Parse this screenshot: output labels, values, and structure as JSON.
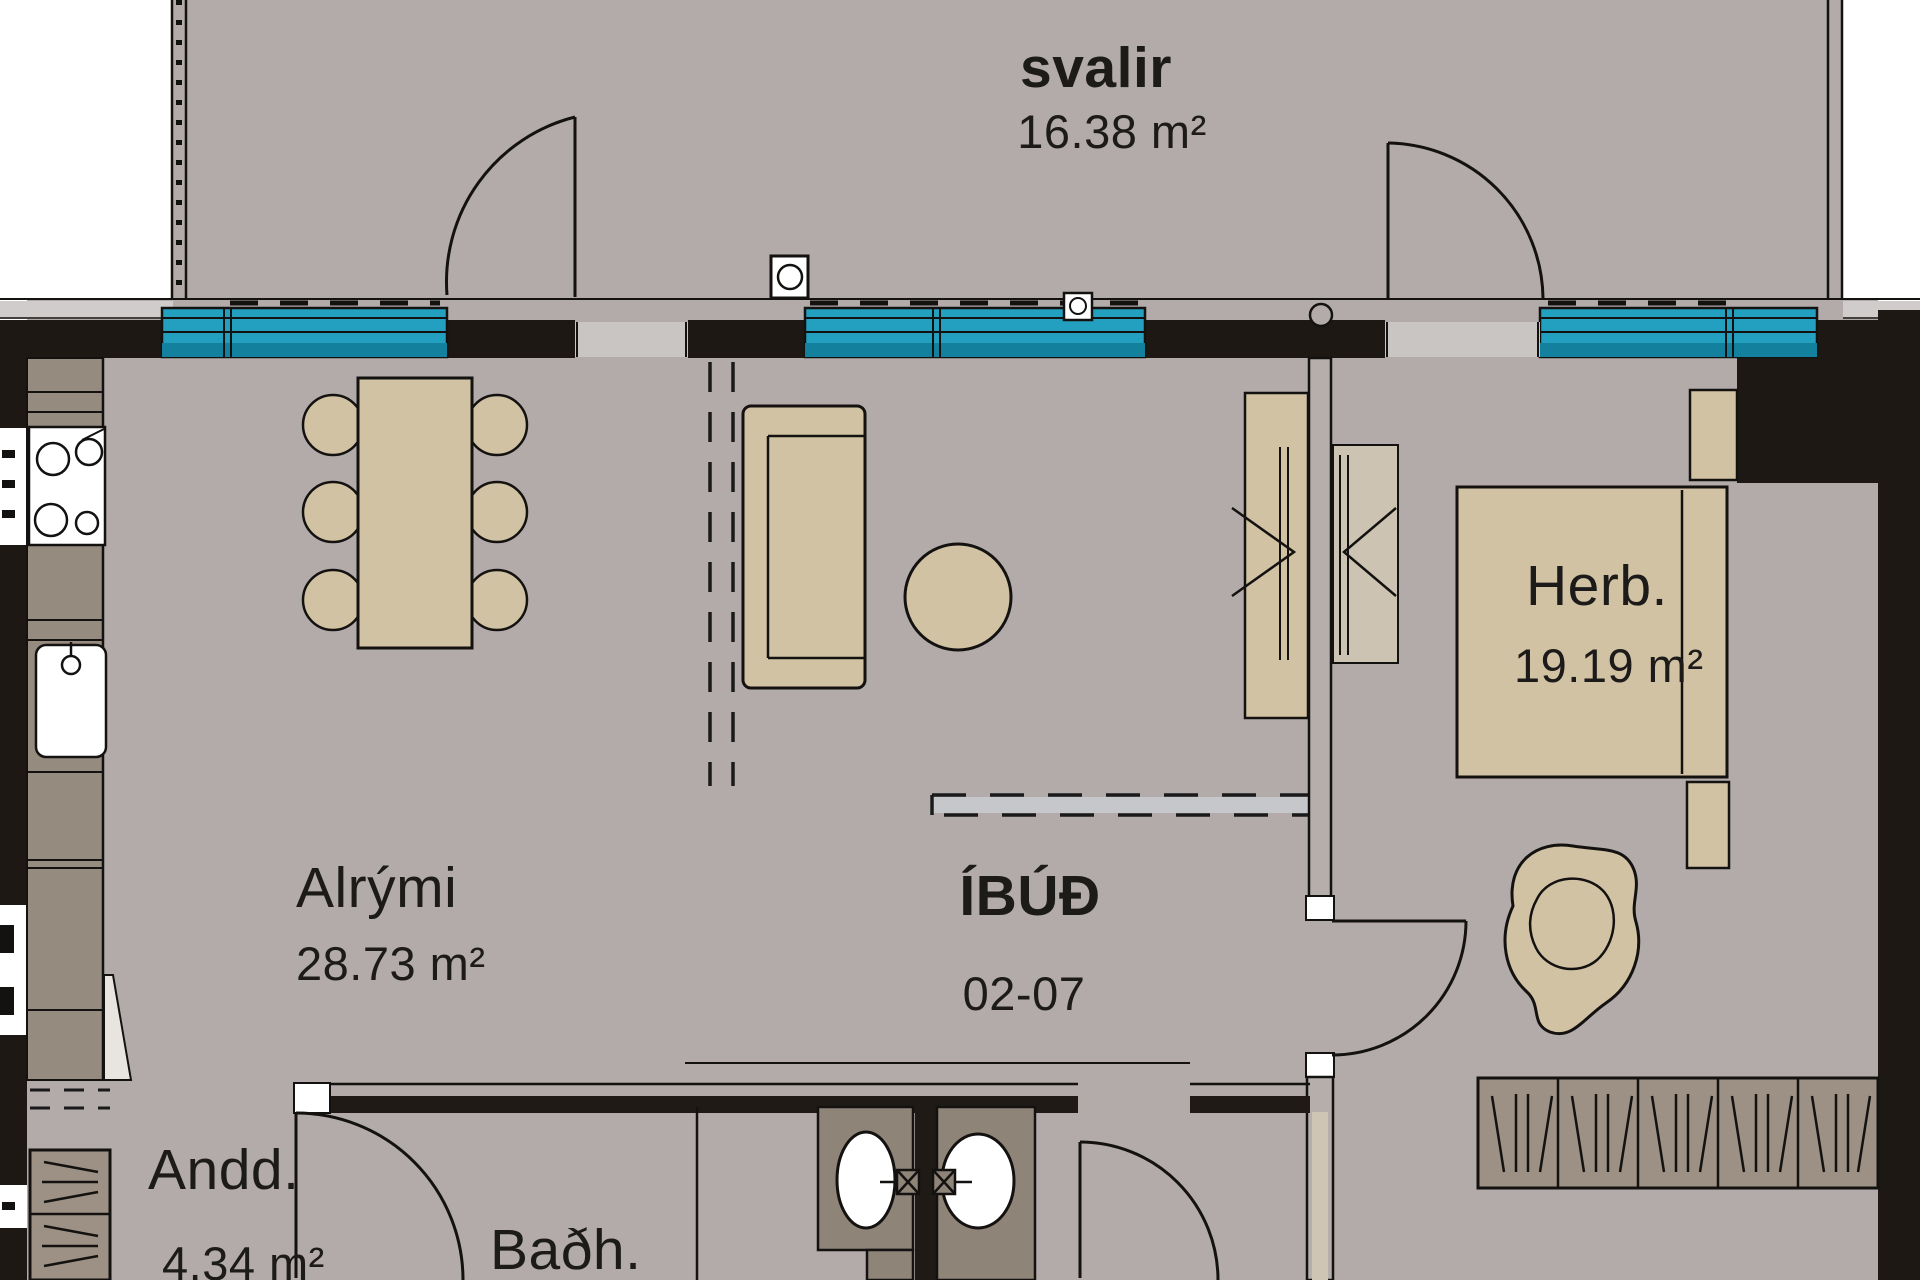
{
  "plan": {
    "type": "apartment floor plan",
    "rooms": {
      "svalir": {
        "name": "svalir",
        "area": "16.38 m²"
      },
      "alrymi": {
        "name": "Alrými",
        "area": "28.73 m²"
      },
      "herb": {
        "name": "Herb.",
        "area": "19.19 m²"
      },
      "andd": {
        "name": "Andd.",
        "area": "4.34 m²"
      },
      "badh": {
        "name": "Baðh."
      },
      "ibud": {
        "name": "ÍBÚÐ",
        "unit": "02-07"
      }
    },
    "colors": {
      "floor": "#b2aba9",
      "outside": "#ffffff",
      "wall": "#1d1814",
      "window_glass": "#23a0bf",
      "window_glass_dark": "#13809e",
      "furniture": "#d2c2a4",
      "counter": "#968b7f",
      "wardrobe": "#9c9184",
      "partition": "#b5aeab",
      "text": "#1d1b19"
    },
    "symbols": [
      "balcony-railing",
      "window",
      "balcony-door",
      "kitchen-counter",
      "stove",
      "kitchen-sink",
      "dining-table",
      "chair",
      "sofa",
      "round-table",
      "hall-closet",
      "bed",
      "nightstand",
      "armchair",
      "wardrobe",
      "washbasin",
      "interior-door",
      "ceiling-dashed-line"
    ]
  }
}
